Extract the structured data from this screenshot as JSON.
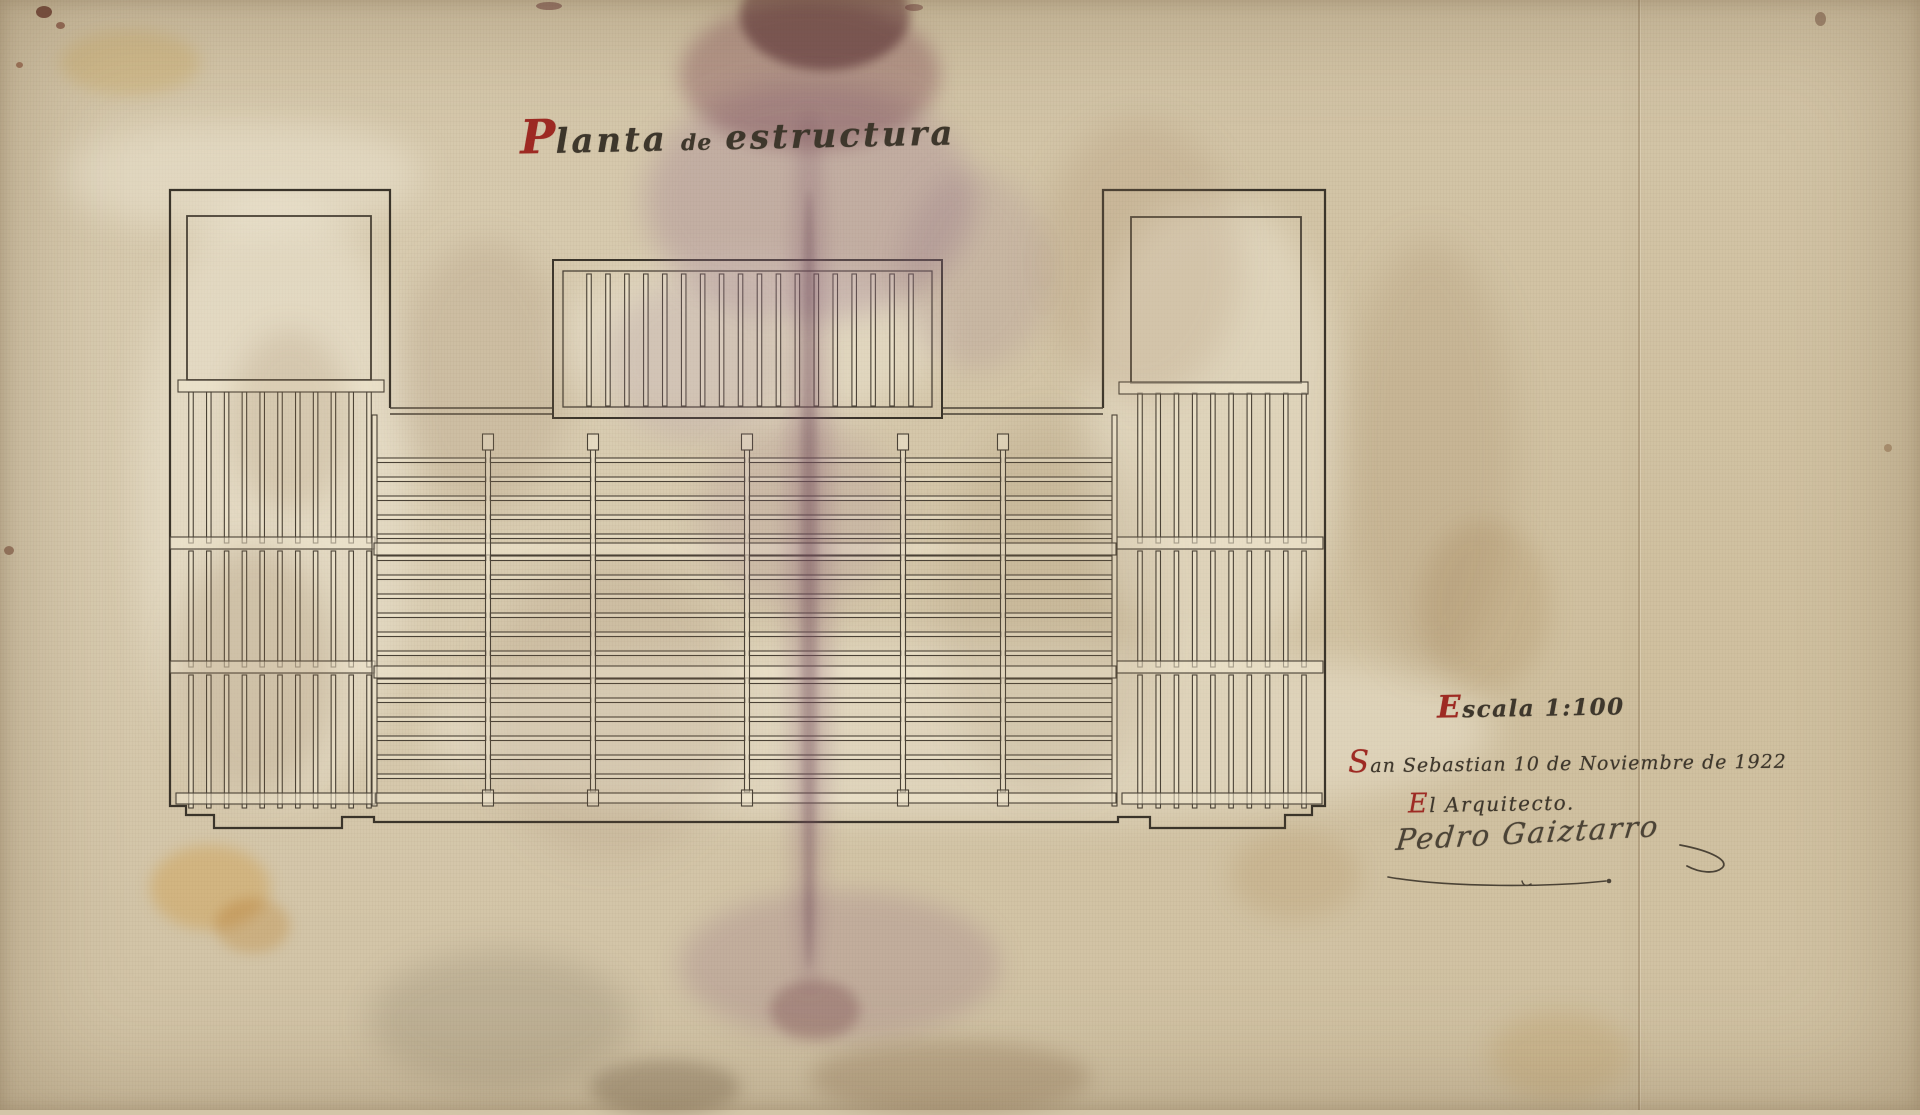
{
  "document": {
    "kind": "Architectural structural floor plan, hand drawn, dated 1922",
    "title": {
      "initial": "P",
      "word1": "lanta",
      "mid": "de",
      "word2": "estructura"
    },
    "scale": {
      "initial": "E",
      "rest": "scala 1:100"
    },
    "place_date": {
      "initial": "S",
      "rest": "an Sebastian 10 de Noviembre de 1922"
    },
    "architect_label": {
      "initial": "E",
      "rest": "l Arquitecto."
    },
    "signature": "Pedro Gaiztarro",
    "colors": {
      "ink": "#4a4236",
      "accent_red": "#9e2a23",
      "paper": "#d3c5a8"
    }
  },
  "plan": {
    "ink": "#4a4236",
    "ink_dark": "#3a342a",
    "strip_fill": "rgba(240,231,208,0.55)",
    "perimeter": "M390,408 V190 H170 V806 H186 V815 H214 V828 H342 V817 H374 V822 H1118 V817 H1150 V828 H1285 V815 H1312 V806 H1325 V190 H1103 V408",
    "notches": [
      {
        "x1": 390,
        "x2": 553
      },
      {
        "x1": 942,
        "x2": 1103
      }
    ],
    "notch_ys": [
      408,
      414
    ],
    "center_block": {
      "outer": [
        553,
        260,
        389,
        158
      ],
      "inner": [
        563,
        271,
        369,
        136
      ],
      "joists": {
        "x0": 589,
        "x1": 911,
        "count": 18,
        "w": 4.5,
        "y0": 274,
        "y1": 406
      }
    },
    "wings": [
      {
        "name": "left",
        "room": [
          187,
          216,
          184,
          164
        ],
        "ledger": [
          178,
          380,
          206,
          12
        ],
        "beams": [
          [
            170,
            537,
            205,
            12
          ],
          [
            170,
            661,
            205,
            12
          ],
          [
            176,
            793,
            199,
            11
          ]
        ],
        "joists": {
          "x0": 191,
          "x1": 369,
          "count": 11,
          "w": 4.5,
          "sections": [
            [
              392,
              543
            ],
            [
              551,
              667
            ],
            [
              675,
              808
            ]
          ]
        }
      },
      {
        "name": "right",
        "room": [
          1131,
          217,
          170,
          166
        ],
        "ledger": [
          1119,
          382,
          189,
          12
        ],
        "beams": [
          [
            1117,
            537,
            206,
            12
          ],
          [
            1117,
            661,
            206,
            12
          ],
          [
            1122,
            793,
            200,
            11
          ]
        ],
        "joists": {
          "x0": 1140,
          "x1": 1304,
          "count": 10,
          "w": 4.5,
          "sections": [
            [
              393,
              543
            ],
            [
              551,
              667
            ],
            [
              675,
              808
            ]
          ]
        }
      }
    ],
    "central": {
      "side_walls": [
        [
          372,
          415,
          5,
          391
        ],
        [
          1112,
          415,
          5,
          391
        ]
      ],
      "beams": [
        [
          374,
          543,
          742,
          12
        ],
        [
          374,
          666,
          742,
          12
        ],
        [
          376,
          793,
          740,
          10
        ]
      ],
      "girders": {
        "xs": [
          488,
          593,
          747,
          903,
          1003
        ],
        "w": 5,
        "y0": 450,
        "y1": 792,
        "post": {
          "w": 11,
          "h": 16,
          "top_y": 434,
          "bot_y": 790
        }
      },
      "bays": [
        [
          377,
          486
        ],
        [
          490,
          591
        ],
        [
          595,
          745
        ],
        [
          749,
          901
        ],
        [
          905,
          1001
        ],
        [
          1005,
          1112
        ]
      ],
      "sections": [
        {
          "y0": 458,
          "count": 5
        },
        {
          "y0": 556,
          "count": 6
        },
        {
          "y0": 679,
          "count": 6
        }
      ],
      "joist_h": 4.5,
      "pitch": 19
    }
  }
}
